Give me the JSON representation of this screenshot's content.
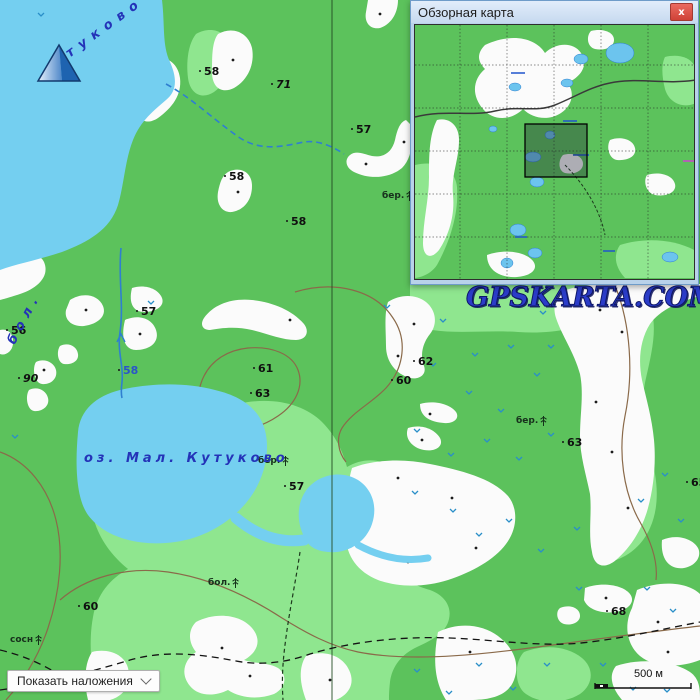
{
  "watermark": {
    "text": "GPSKARTA.COM",
    "color": "#2b3cc8"
  },
  "overview_panel": {
    "title": "Обзорная карта",
    "close_icon": "x"
  },
  "controls": {
    "overlays_button_label": "Показать наложения",
    "scale_bar_label": "500 м"
  },
  "map": {
    "lake_label_small": "оз. Мал. Кутуково",
    "lake_label_big_part1": "бол.",
    "lake_label_big_part2": "туково",
    "spot_heights": [
      "58",
      "71",
      "57",
      "58",
      "58",
      "57",
      "56",
      "90",
      "61",
      "63",
      "62",
      "60",
      "63",
      "65",
      "57",
      "60",
      "68",
      "58"
    ],
    "veg_labels": [
      "бер.",
      "бер.",
      "бер.",
      "бол.",
      "сосн"
    ],
    "colors": {
      "forest_green": "#5cc25c",
      "light_green": "#8fe68f",
      "water_blue": "#74cff0",
      "contour_brown": "#8a6a4a",
      "stream_blue": "#2f7fd0",
      "marsh_blue": "#2a8fc8"
    }
  }
}
